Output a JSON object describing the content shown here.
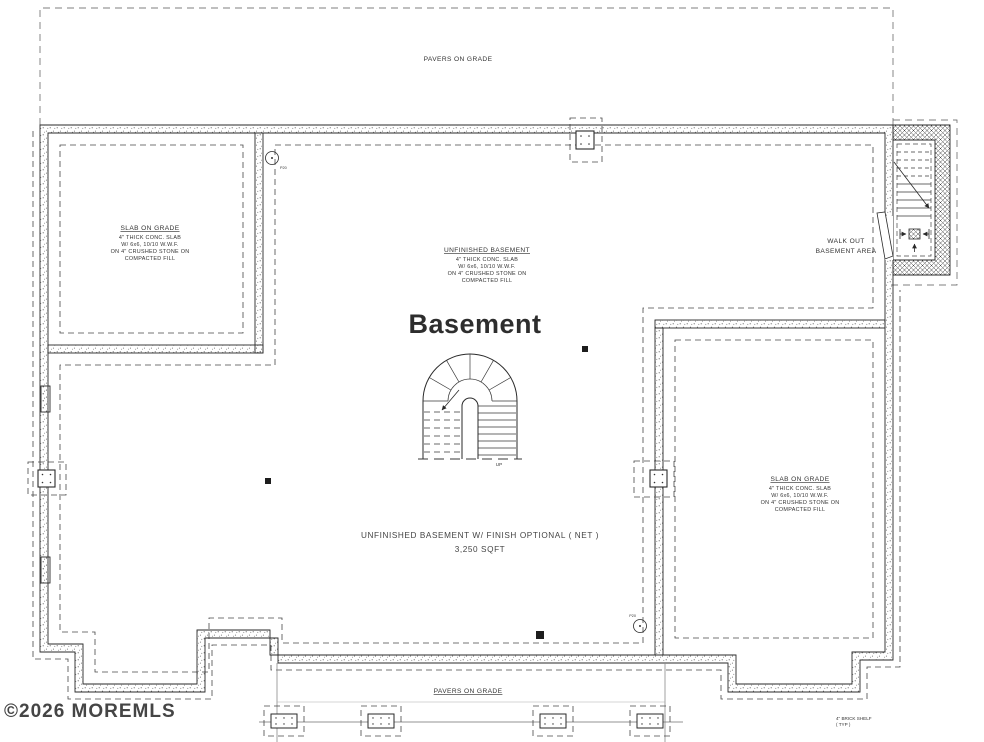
{
  "colors": {
    "ink": "#2a2a2a",
    "dash": "#4a4a4a",
    "watermark": "#454545",
    "background": "#ffffff"
  },
  "labels": {
    "pavers_top": "PAVERS ON GRADE",
    "pavers_bottom": "PAVERS ON GRADE",
    "basement_title": "Basement",
    "walkout_line1": "WALK OUT",
    "walkout_line2": "BASEMENT AREA",
    "net_line1": "UNFINISHED BASEMENT W/ FINISH OPTIONAL ( NET )",
    "net_line2": "3,250 SQFT",
    "brick_shelf_line1": "4\" BRICK SHELF",
    "brick_shelf_line2": "( TYP )",
    "up": "UP",
    "pier_tag_top": "P20",
    "pier_tag_bottom": "P20",
    "watermark": "©2026 MOREMLS"
  },
  "notes": {
    "slab_left": {
      "title": "SLAB ON GRADE",
      "lines": [
        "4\" THICK CONC. SLAB",
        "W/ 6x6, 10/10 W.W.F.",
        "ON 4\" CRUSHED STONE ON",
        "COMPACTED FILL"
      ]
    },
    "unfinished": {
      "title": "UNFINISHED BASEMENT",
      "lines": [
        "4\" THICK CONC. SLAB",
        "W/ 6x6, 10/10 W.W.F.",
        "ON 4\" CRUSHED STONE ON",
        "COMPACTED FILL"
      ]
    },
    "slab_right": {
      "title": "SLAB ON GRADE",
      "lines": [
        "4\" THICK CONC. SLAB",
        "W/ 6x6, 10/10 W.W.F.",
        "ON 4\" CRUSHED STONE ON",
        "COMPACTED FILL"
      ]
    }
  }
}
